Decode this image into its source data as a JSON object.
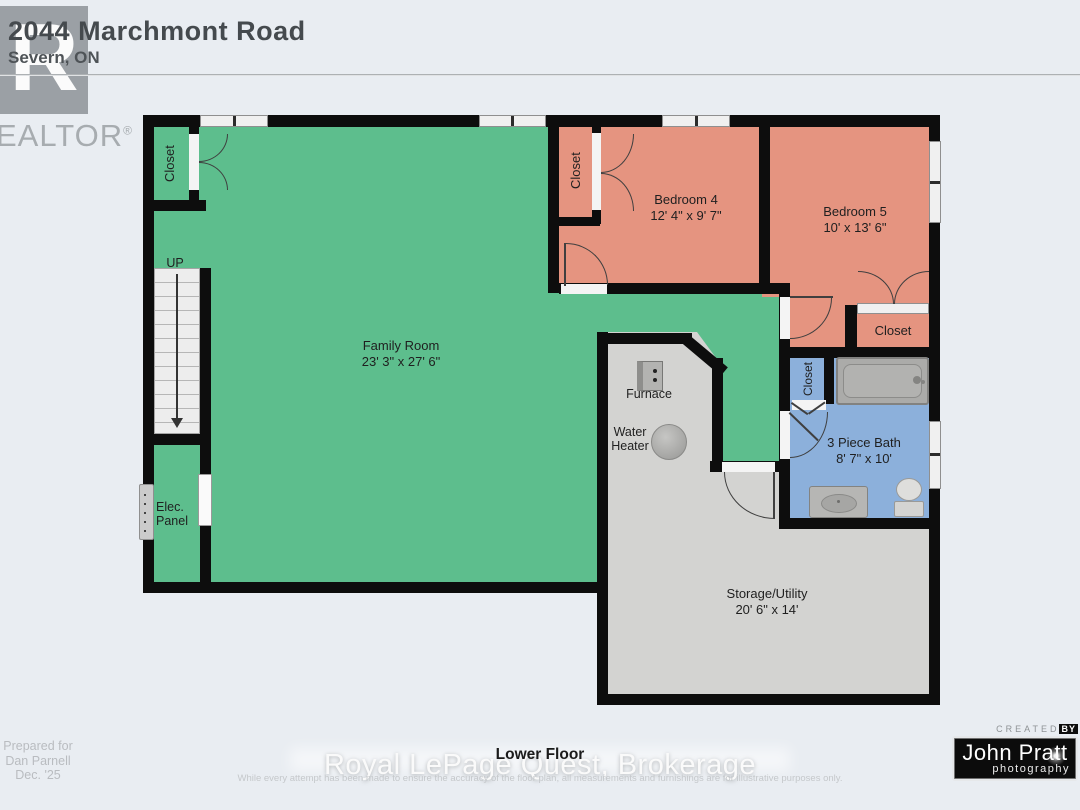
{
  "header": {
    "address": "2044 Marchmont Road",
    "city": "Severn, ON",
    "logo_r": "R",
    "logo_word": "EALTOR",
    "logo_reg": "®"
  },
  "plan": {
    "family": {
      "name": "Family Room",
      "dims": "23' 3\" x 27' 6\""
    },
    "bedroom4": {
      "name": "Bedroom 4",
      "dims": "12' 4\" x 9' 7\""
    },
    "bedroom5": {
      "name": "Bedroom 5",
      "dims": "10' x 13' 6\""
    },
    "bath": {
      "name": "3 Piece Bath",
      "dims": "8' 7\" x 10'"
    },
    "storage": {
      "name": "Storage/Utility",
      "dims": "20' 6\" x 14'"
    },
    "closet_label": "Closet",
    "up_label": "UP",
    "elec_line1": "Elec.",
    "elec_line2": "Panel",
    "furnace_label": "Furnace",
    "water_line1": "Water",
    "water_line2": "Heater"
  },
  "footer": {
    "prepared_line1": "Prepared for",
    "prepared_line2": "Dan Parnell",
    "prepared_line3": "Dec. '25",
    "floor_label": "Lower Floor",
    "watermark": "Royal LePage Quest, Brokerage",
    "disclaimer": "While every attempt has been made to ensure the accuracy of the floor plan, all measurements and furnishings are for illustrative purposes only.",
    "credit_created": "CREATED",
    "credit_by": "BY",
    "credit_name": "John Pratt",
    "credit_sub": "photography"
  },
  "colors": {
    "room_green": "#5dbe8d",
    "room_salmon": "#e59480",
    "room_blue": "#8cb0db",
    "room_gray": "#d3d3d1",
    "wall": "#0d0d0d",
    "background": "#e9edf2"
  }
}
